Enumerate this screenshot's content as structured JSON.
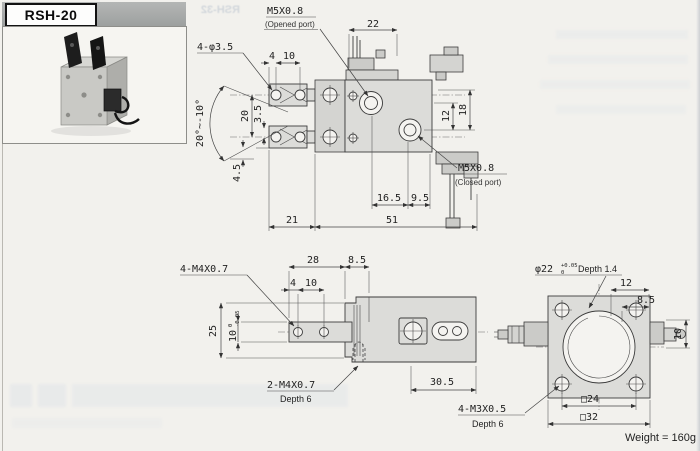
{
  "header": {
    "model": "RSH-20"
  },
  "ghost": {
    "model_reverse": "RSH-32"
  },
  "top_view": {
    "opened_port": {
      "thread": "M5X0.8",
      "caption": "(Opened port)"
    },
    "closed_port": {
      "thread": "M5X0.8",
      "caption": "(Closed port)"
    },
    "holes_label": "4-φ3.5",
    "angle_label": "20°~-10°",
    "dims": {
      "valve_width": "22",
      "hole_edge": "4",
      "hole_pitch": "10",
      "arm_span": "20",
      "arm_half": "3.5",
      "arm_bottom": "4.5",
      "port_pitch_v": "12",
      "port_offset_v": "18",
      "port_x1": "16.5",
      "port_x2": "9.5",
      "arm_length": "21",
      "body_length": "51"
    }
  },
  "side_view": {
    "holes_label": "4-M4X0.7",
    "tapped_label": "2-M4X0.7",
    "tapped_depth": "Depth 6",
    "dims": {
      "body_top": "28",
      "step": "8.5",
      "hole_edge": "4",
      "hole_pitch": "10",
      "height": "25",
      "plate_main": "10",
      "plate_tol_upper": "0",
      "plate_tol_lower": "-0.05",
      "body_right": "30.5"
    }
  },
  "end_view": {
    "bore": {
      "main": "φ22",
      "tol_upper": "+0.05",
      "tol_lower": "0",
      "suffix": "Depth 1.4"
    },
    "tapped_label": "4-M3X0.5",
    "tapped_depth": "Depth 6",
    "dims": {
      "top_right": "12",
      "side": "8.5",
      "fitting": "10",
      "bolt_square": "□24",
      "body_square": "□32"
    }
  },
  "footer": {
    "weight": "Weight = 160g"
  }
}
